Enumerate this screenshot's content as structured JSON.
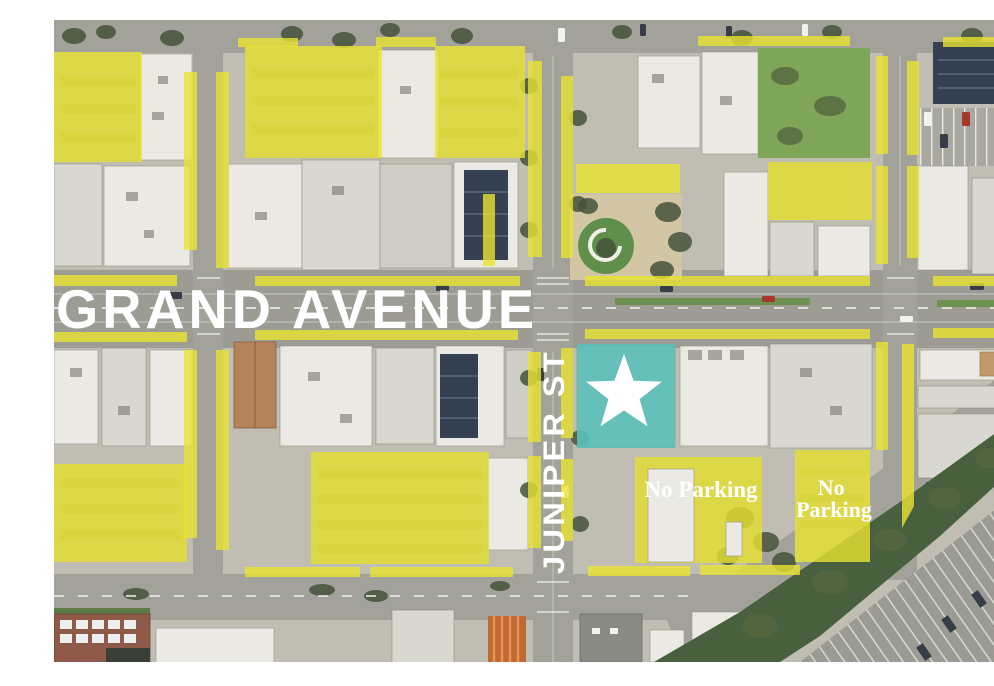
{
  "figure": {
    "street_labels": {
      "grand_avenue": "GRAND AVENUE",
      "juniper_st": "JUNIPER ST"
    },
    "annotations": {
      "no_parking_1": "No Parking",
      "no_parking_2_line1": "No",
      "no_parking_2_line2": "Parking"
    }
  },
  "colors": {
    "highlight_yellow": "#e8e431",
    "site_teal": "#5abdb6",
    "label_white": "#ffffff"
  }
}
